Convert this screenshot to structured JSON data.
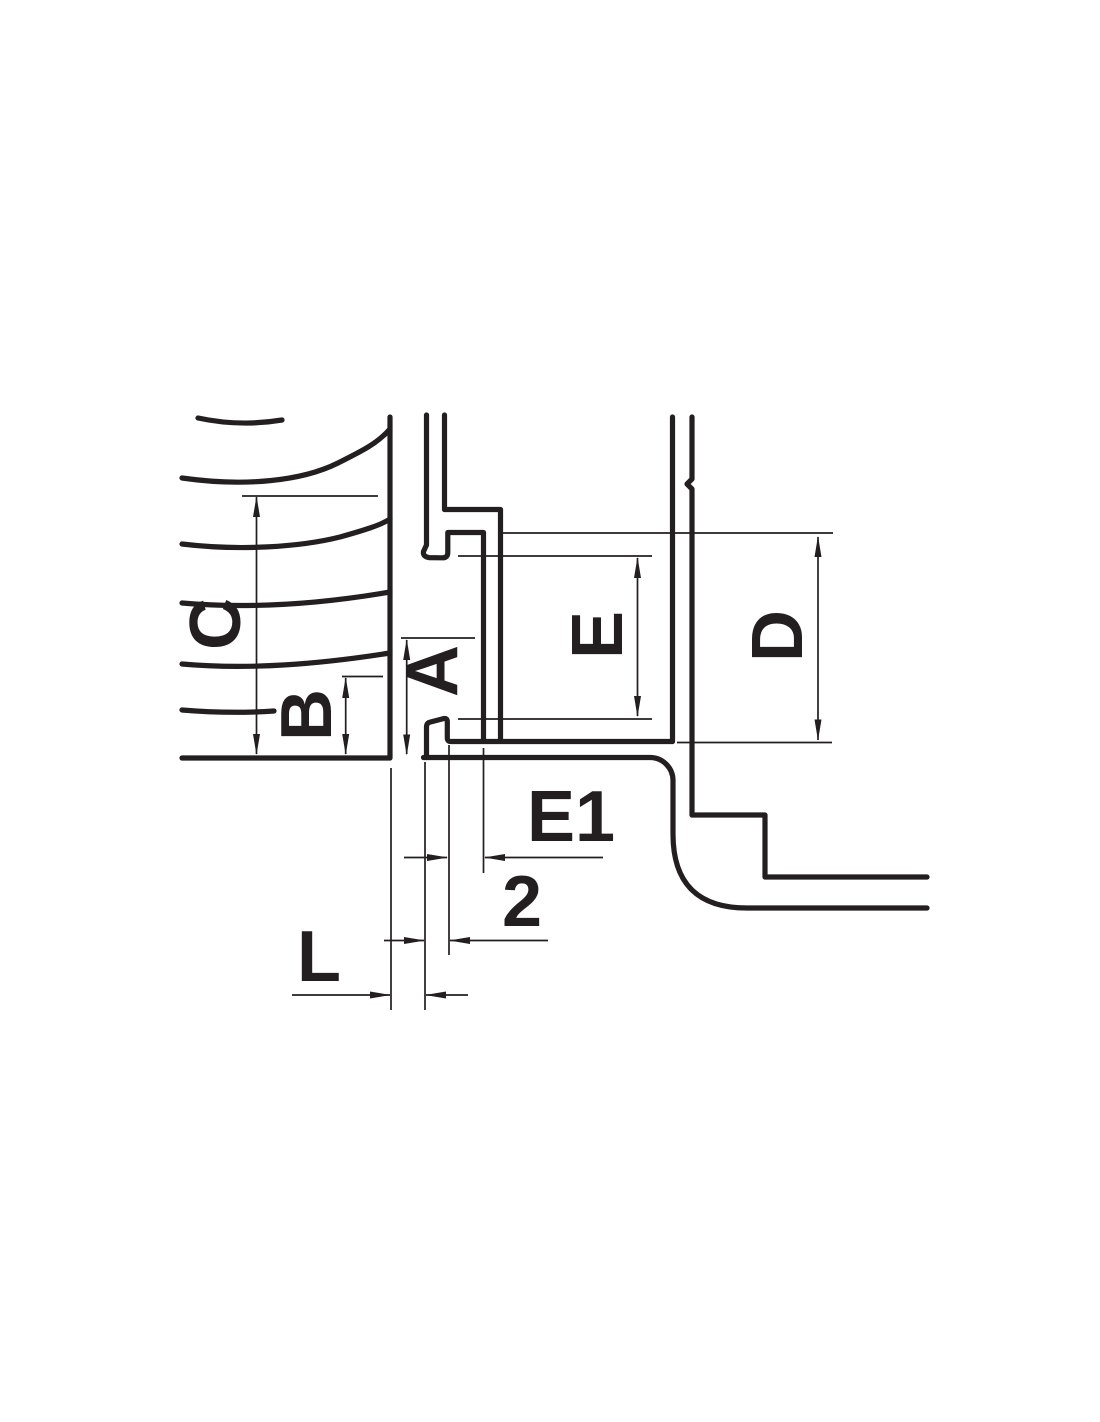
{
  "diagram": {
    "labels": {
      "c": "C",
      "b": "B",
      "a": "A",
      "e": "E",
      "d": "D",
      "e1": "E1",
      "two": "2",
      "l": "L"
    },
    "colors": {
      "line": "#231f20",
      "background": "#ffffff"
    }
  }
}
